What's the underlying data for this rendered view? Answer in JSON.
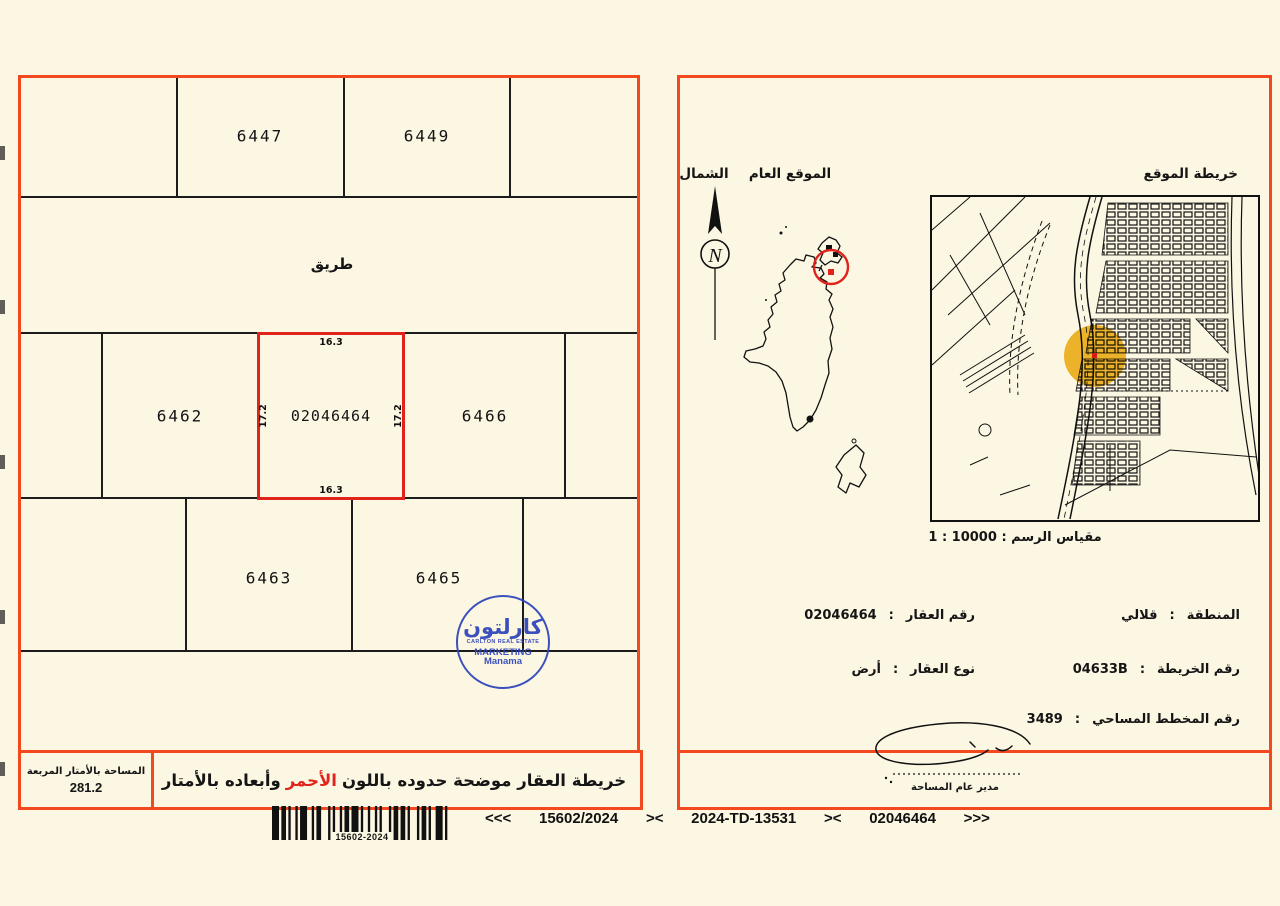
{
  "ui": {
    "colon": ":"
  },
  "colors": {
    "accent_red": "#f4481f",
    "plot_red": "#e0241c",
    "carlton_blue": "#2e44bb",
    "highlight_yellow": "#edb012"
  },
  "plot_map": {
    "road_label": "طريق",
    "parcels": {
      "p6447": "6447",
      "p6449": "6449",
      "p6462": "6462",
      "p6466": "6466",
      "p6463": "6463",
      "p6465": "6465"
    },
    "subject": {
      "number": "02046464",
      "dim_top": "16.3",
      "dim_bottom": "16.3",
      "dim_left": "17.2",
      "dim_right": "17.2"
    },
    "area_box": {
      "label": "المساحة بالأمتار المربعة",
      "value": "281.2"
    },
    "caption": {
      "prefix": "خريطة العقار موضحة حدوده باللون",
      "red_word": "الأحمر",
      "suffix": "وأبعاده بالأمتار"
    }
  },
  "stamp": {
    "arabic": "كارلتون",
    "line1": "CARLTON REAL ESTATE",
    "line2": "MARKETING",
    "line3": "Manama"
  },
  "location_panel": {
    "north_label": "الشمال",
    "north_letter": "N",
    "general_location_label": "الموقع العام",
    "site_map_label": "خريطة الموقع",
    "scale_label": "مقياس الرسم",
    "scale_value": "10000",
    "scale_unit": "1",
    "details_left": [
      {
        "label": "رقم العقار",
        "value": "02046464"
      },
      {
        "label": "نوع العقار",
        "value": "أرض"
      }
    ],
    "details_right": [
      {
        "label": "المنطقة",
        "value": "قلالي"
      },
      {
        "label": "رقم الخريطة",
        "value": "04633B"
      },
      {
        "label": "رقم المخطط المساحي",
        "value": "3489"
      }
    ],
    "signature_label": "مدير عام المساحة"
  },
  "footer": {
    "barcode_label": "15602-2024",
    "refs": [
      "<<<",
      "15602/2024",
      "><",
      "2024-TD-13531",
      "><",
      "02046464",
      ">>>"
    ]
  }
}
